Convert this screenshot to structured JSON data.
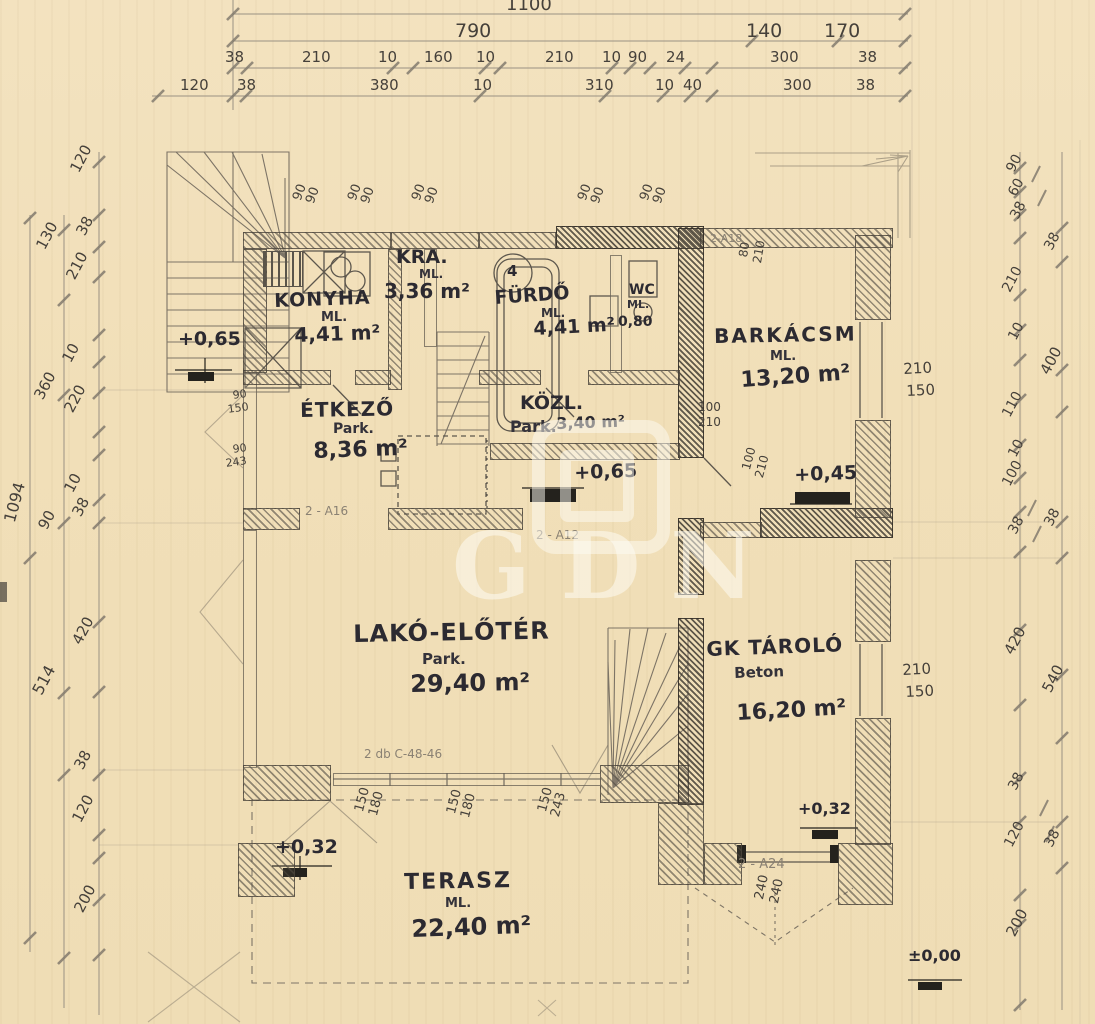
{
  "dims": {
    "top_row1": [
      "1100"
    ],
    "top_row2": [
      "790",
      "140",
      "170"
    ],
    "top_row3": [
      "38",
      "210",
      "10",
      "160",
      "10",
      "210",
      "10",
      "90",
      "24",
      "300",
      "38"
    ],
    "top_row4": [
      "120",
      "38",
      "380",
      "10",
      "310",
      "10",
      "40",
      "300",
      "38"
    ],
    "left_inner": [
      "120",
      "38",
      "210",
      "10",
      "220",
      "10",
      "38",
      "420",
      "38",
      "120",
      "200"
    ],
    "left_mid": [
      "130",
      "360",
      "90",
      "514"
    ],
    "left_outer": [
      "1094"
    ],
    "right_inner": [
      "90",
      "60",
      "38",
      "210",
      "10",
      "110",
      "10",
      "100",
      "38",
      "420",
      "38",
      "120",
      "200"
    ],
    "right_outer": [
      "38",
      "400",
      "38",
      "540",
      "38"
    ]
  },
  "rooms": [
    {
      "name": "KONYHA",
      "sub": "ML.",
      "area": "4,41 m²"
    },
    {
      "name": "KRA.",
      "sub": "ML.",
      "area": "3,36 m²"
    },
    {
      "name": "FÜRDŐ",
      "sub": "ML.",
      "area": "4,41 m²"
    },
    {
      "name": "WC",
      "sub": "ML.",
      "area": "0,80"
    },
    {
      "name": "BARKÁCSM",
      "sub": "ML.",
      "area": "13,20 m²"
    },
    {
      "name": "ÉTKEZŐ",
      "sub": "Park.",
      "area": "8,36 m²"
    },
    {
      "name": "KÖZL.",
      "sub": "Park.",
      "area": "3,40 m²"
    },
    {
      "name": "LAKÓ-ELŐTÉR",
      "sub": "Park.",
      "area": "29,40 m²"
    },
    {
      "name": "GK TÁROLÓ",
      "sub": "Beton",
      "area": "16,20 m²"
    },
    {
      "name": "TERASZ",
      "sub": "ML.",
      "area": "22,40 m²"
    }
  ],
  "levels": {
    "stair_top": "+0,65",
    "hall": "+0,65",
    "gk": "+0,45",
    "terrace": "+0,32",
    "garage_front": "+0,32",
    "ground": "±0,00"
  },
  "wall_labels": {
    "top_right": "2-A18",
    "etkezo": "2 - A16",
    "hall": "2 - A12",
    "garage": "2 - A24",
    "beam_note": "2 db C-48-46"
  },
  "openings": {
    "top_window_pairs": [
      "90",
      "90",
      "90",
      "90",
      "90",
      "90",
      "90",
      "90",
      "90",
      "90"
    ],
    "etkezo_left": [
      "90",
      "150",
      "90",
      "243"
    ],
    "door_barkacs": [
      "80",
      "210"
    ],
    "door_wc": [
      "100",
      "210"
    ],
    "door_gk": [
      "100",
      "210"
    ],
    "window_barkacs": [
      "210",
      "150"
    ],
    "window_gk": [
      "210",
      "150"
    ],
    "window_living_1": [
      "150",
      "180"
    ],
    "window_living_2": [
      "150",
      "180"
    ],
    "window_living_3": [
      "150",
      "243"
    ],
    "door_garage": [
      "240",
      "240"
    ]
  },
  "annotations": {
    "bath_room_number": "4"
  },
  "watermark": {
    "text": "GDN"
  }
}
